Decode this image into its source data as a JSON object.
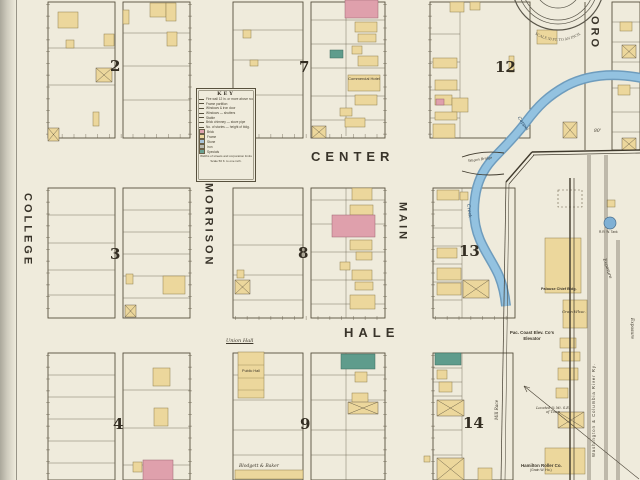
{
  "streets": {
    "college": "COLLEGE",
    "morrison": "MORRISON",
    "main": "MAIN",
    "oro": "ORO",
    "center": "CENTER",
    "hale": "HALE"
  },
  "blocks": {
    "b2": "2",
    "b3": "3",
    "b4": "4",
    "b7": "7",
    "b8": "8",
    "b9": "9",
    "b12": "12",
    "b13": "13",
    "b14": "14"
  },
  "key": {
    "title": "KEY",
    "rows": [
      "Fire wall 12 in. or more above roof",
      "Frame partition",
      "Windows & iron door",
      "Windows — shutters",
      "Stable",
      "Brick chimney — stove pipe",
      "No. of stories — height of bldg."
    ],
    "swatches": [
      {
        "label": "Brick",
        "color": "#dfa3ae"
      },
      {
        "label": "Frame",
        "color": "#eed9a0"
      },
      {
        "label": "Stone",
        "color": "#a8c3da"
      },
      {
        "label": "Iron",
        "color": "#b9b9b2"
      },
      {
        "label": "Specials",
        "color": "#6ba293"
      }
    ],
    "footer1": "Widths of streets and corporation limits",
    "footer2": "Scale 50 ft. to one inch."
  },
  "labels": {
    "commercial_hotel": "Commercial Hotel",
    "union_hall": "Union Hall",
    "public_hall": "Public Hall",
    "blodgett": "Blodgett & Baker",
    "wagon_bridge": "Wagon Bridge",
    "coppei": "Coppei",
    "creek": "Creek",
    "mill_race": "Mill Race",
    "pac_coast_line1": "Pac. Coast Elev. Co's",
    "pac_coast_line2": "Elevator",
    "palouse_chief": "Palouse Chief Bldg.",
    "grain_whse": "Grain Whse.",
    "hamilton_line1": "Hamilton Roller Co.",
    "hamilton_line2": "(Grain W. Ho.)",
    "railroad": "Washington & Columbia River Ry.",
    "exposure_left": "Exposure",
    "exposure_right": "Exposure",
    "rr_tank": "R.R. W. Tank",
    "located": "Located ¼ Mi. S.E. of Town",
    "oro_width": "80'",
    "seal_text": "SCALE 50 FT. TO AN INCH."
  },
  "colors": {
    "paper": "#efebdc",
    "frame_yellow": "#ecd79c",
    "brick_pink": "#dfa0ac",
    "special_green": "#5f9c8c",
    "water_blue": "#93c2e0",
    "ink": "#4a4336"
  }
}
